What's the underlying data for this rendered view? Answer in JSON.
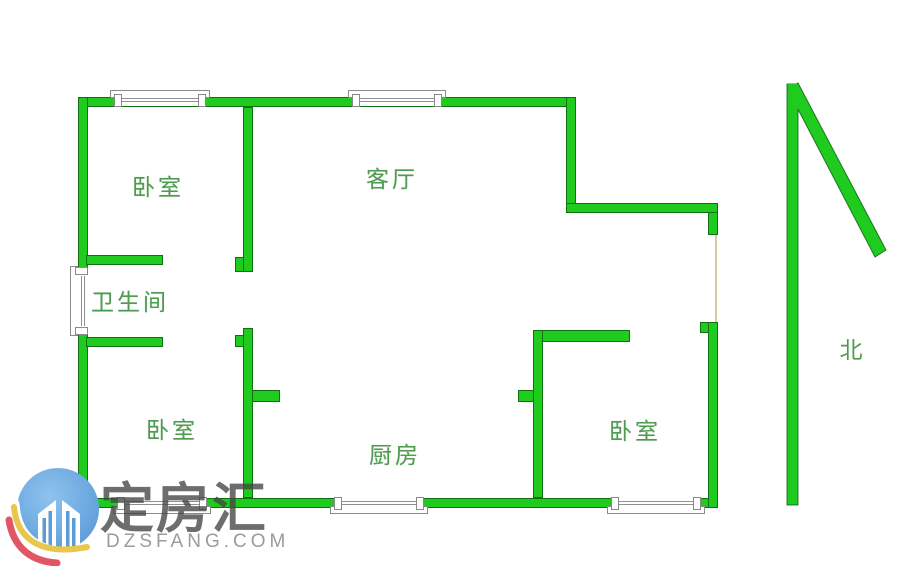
{
  "floorplan": {
    "rooms": {
      "bedroom_nw": "卧室",
      "living_room": "客厅",
      "bathroom": "卫生间",
      "bedroom_sw": "卧室",
      "kitchen": "厨房",
      "bedroom_se": "卧室"
    },
    "compass_north": "北"
  },
  "watermark": {
    "brand": "定房汇",
    "domain": "DZSFANG.COM"
  },
  "colors": {
    "wall_fill": "#1fcb1f",
    "wall_outline": "#0c5a0c",
    "room_label_text": "#4f9b51",
    "window_frame": "#8a8a8a",
    "door_opening_line": "#d6cba4",
    "logo_circle_blue": "#5b9bd8",
    "logo_swoosh_yellow": "#e9c64d",
    "logo_swoosh_red": "#e15665",
    "watermark_brand_text": "#444444",
    "watermark_domain_text": "#9b9b9b"
  }
}
